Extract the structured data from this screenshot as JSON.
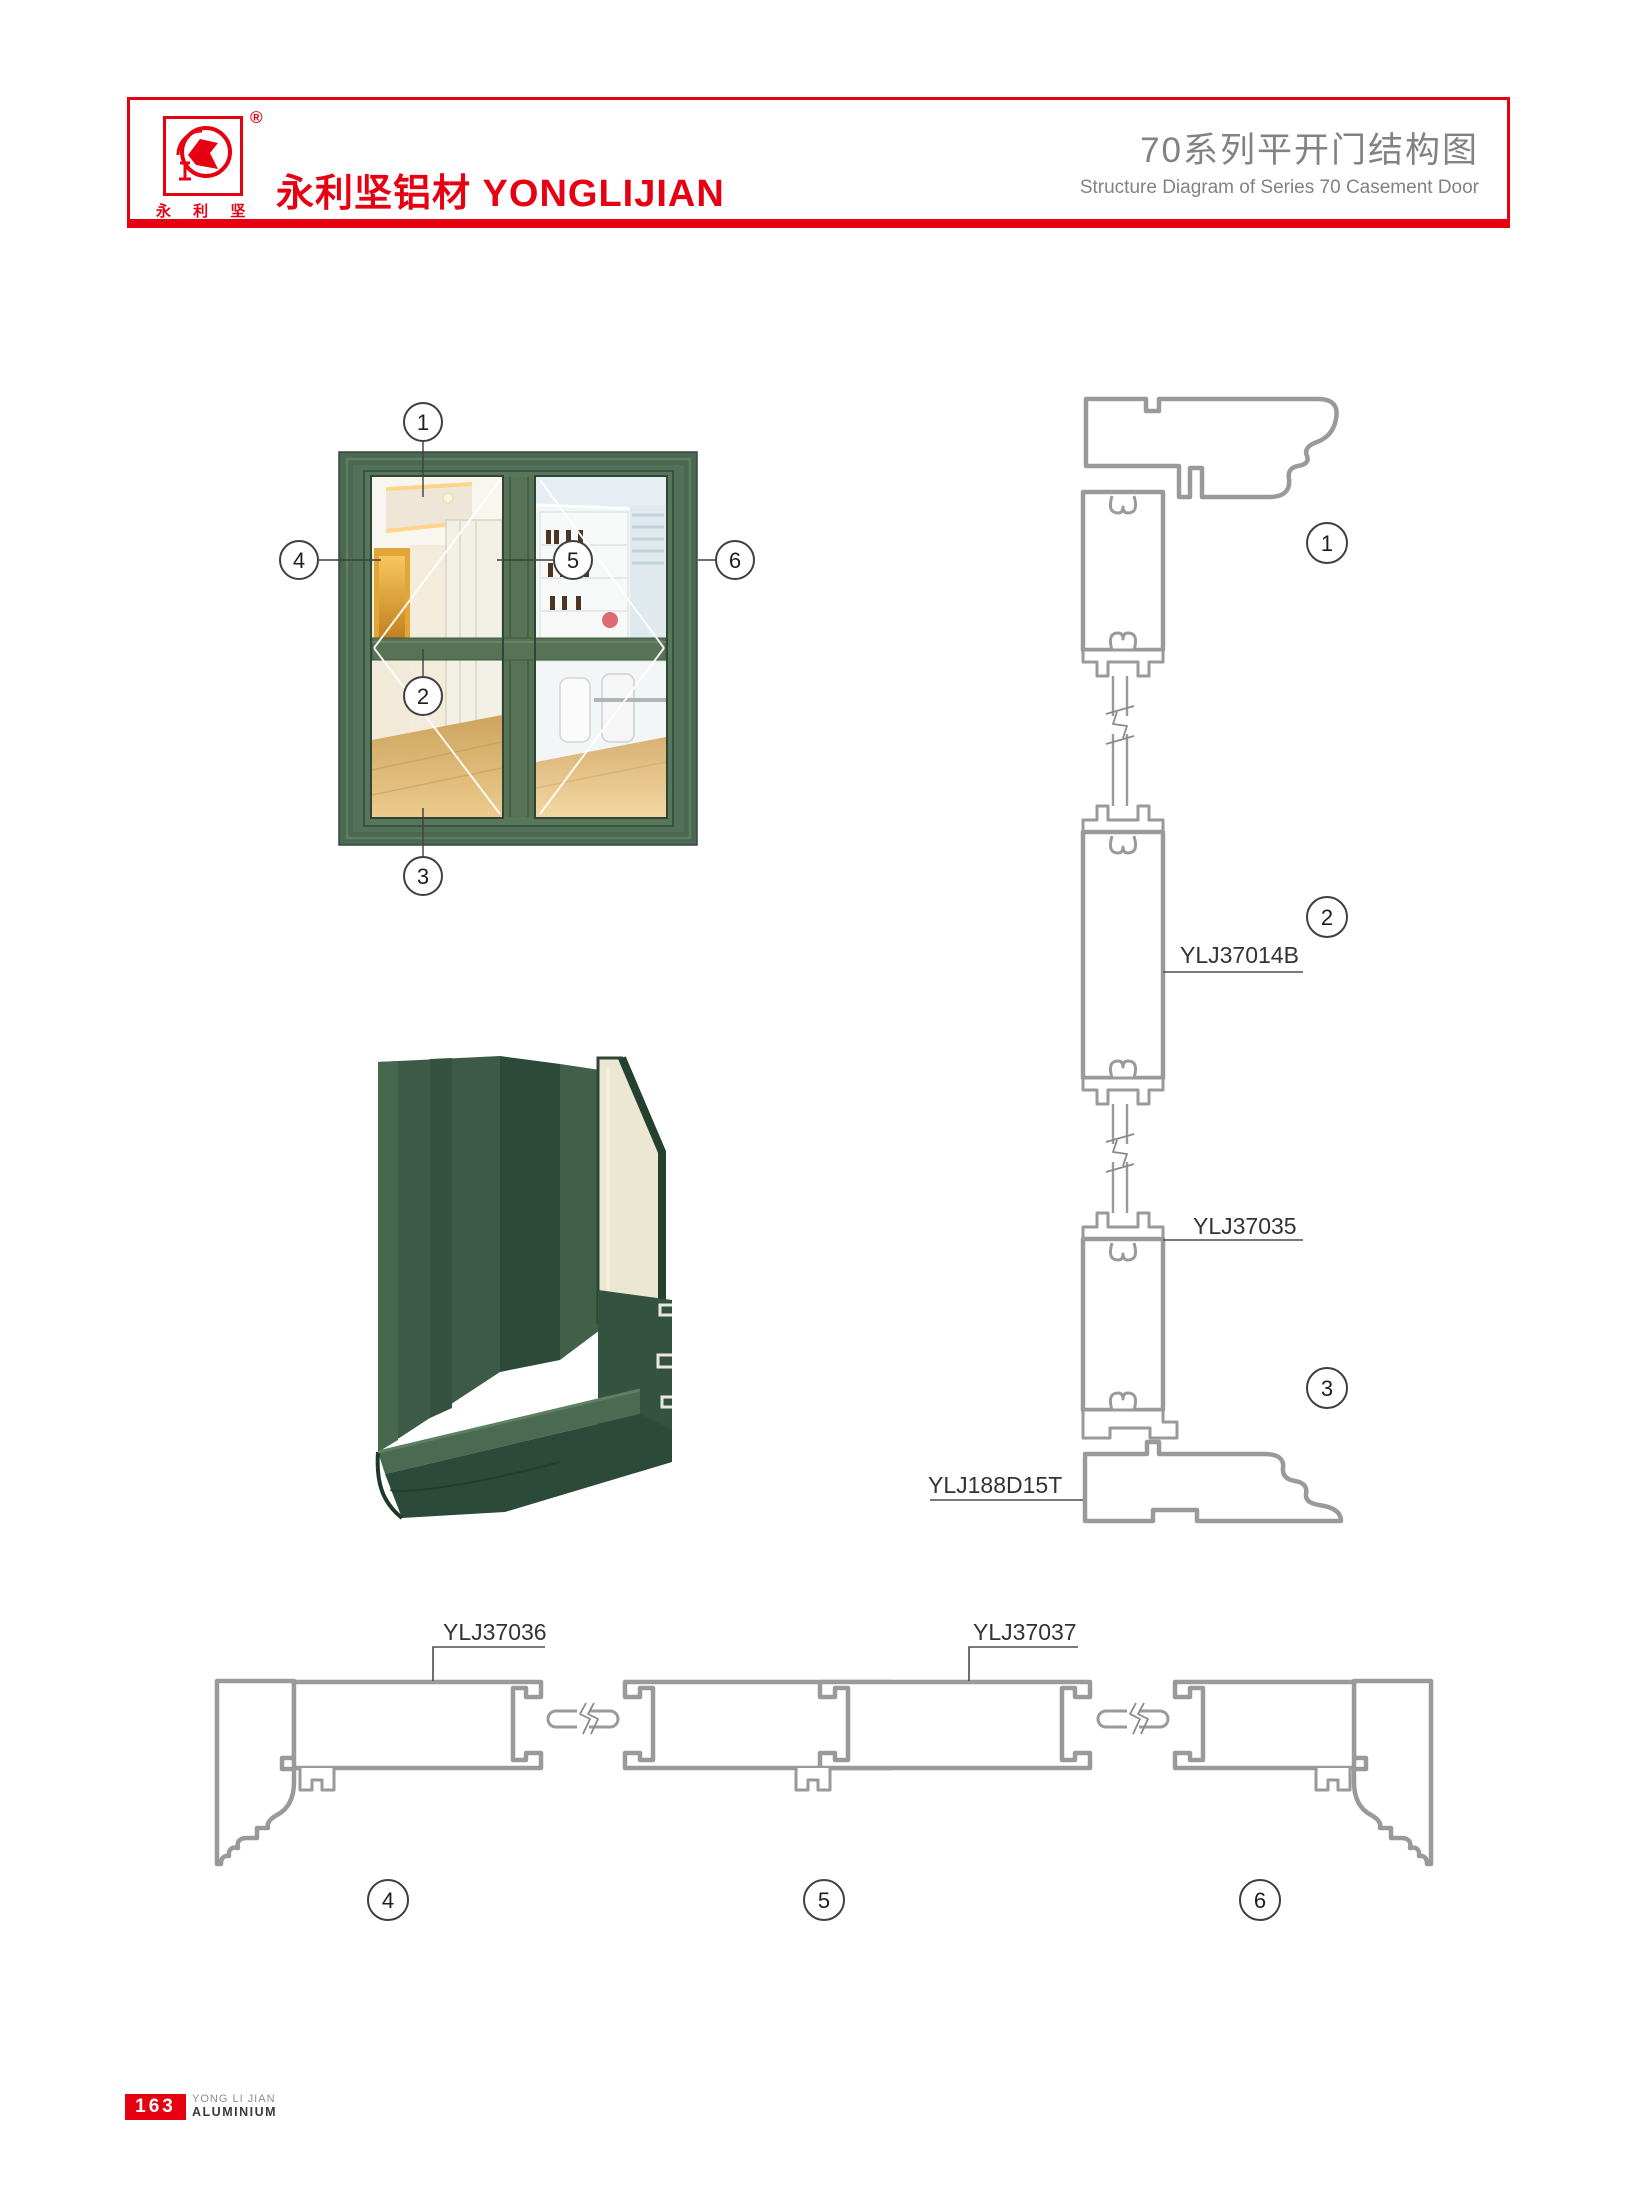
{
  "header": {
    "brand": "永利坚铝材 YONGLIJIAN",
    "logo_characters": "永 利 坚",
    "registered": "®",
    "title_cn": "70系列平开门结构图",
    "title_en": "Structure Diagram of Series 70 Casement Door",
    "accent_color": "#e60012",
    "title_color": "#808285"
  },
  "door_figure": {
    "frame_color": "#53705a",
    "callouts": {
      "c1": "1",
      "c2": "2",
      "c3": "3",
      "c4": "4",
      "c5": "5",
      "c6": "6"
    }
  },
  "vertical_section": {
    "callout_head_frame": "1",
    "callout_transom": "2",
    "callout_threshold": "3",
    "label_transom": "YLJ37014B",
    "label_bottom_rail": "YLJ37035",
    "label_threshold": "YLJ188D15T"
  },
  "horizontal_section": {
    "callout_left_jamb": "4",
    "callout_meeting_stile": "5",
    "callout_right_jamb": "6",
    "label_left_rail": "YLJ37036",
    "label_right_rail": "YLJ37037"
  },
  "footer": {
    "page_number": "163",
    "company_line1": "YONG LI JIAN",
    "company_line2": "ALUMINIUM"
  }
}
